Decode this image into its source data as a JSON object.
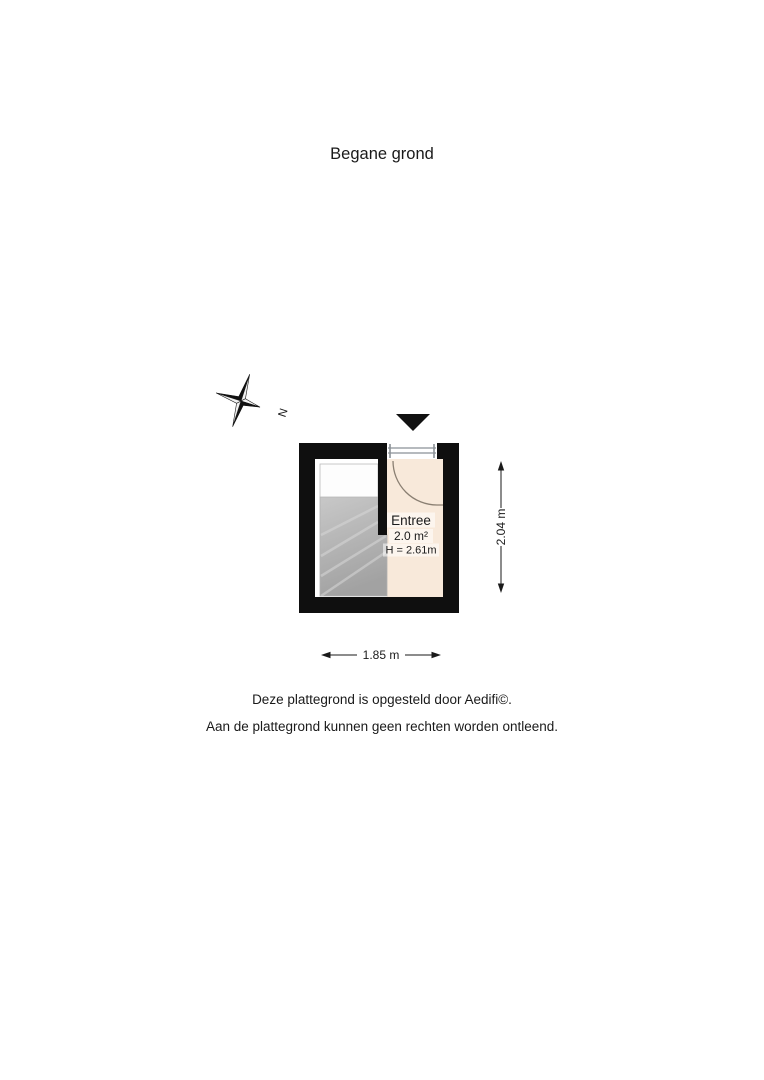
{
  "page": {
    "title": "Begane grond",
    "footer": {
      "line1": "Deze plattegrond is opgesteld door Aedifi©.",
      "line2": "Aan de plattegrond kunnen geen rechten worden ontleend."
    }
  },
  "compass": {
    "north_label": "N"
  },
  "floor_plan": {
    "room": {
      "name": "Entree",
      "area": "2.0 m²",
      "ceiling_height": "H = 2.61m"
    },
    "dimensions": {
      "horizontal": "1.85 m",
      "vertical": "2.04 m"
    },
    "colors": {
      "wall": "#0f0f0f",
      "room_fill": "#f8e9da",
      "stair_fill_top": "#c8c8c8",
      "stair_fill_bottom": "#a2a2a2",
      "stair_landing": "#fdfdfd",
      "door_frame": "#8b9196",
      "door_arc": "#8a7f72"
    }
  }
}
